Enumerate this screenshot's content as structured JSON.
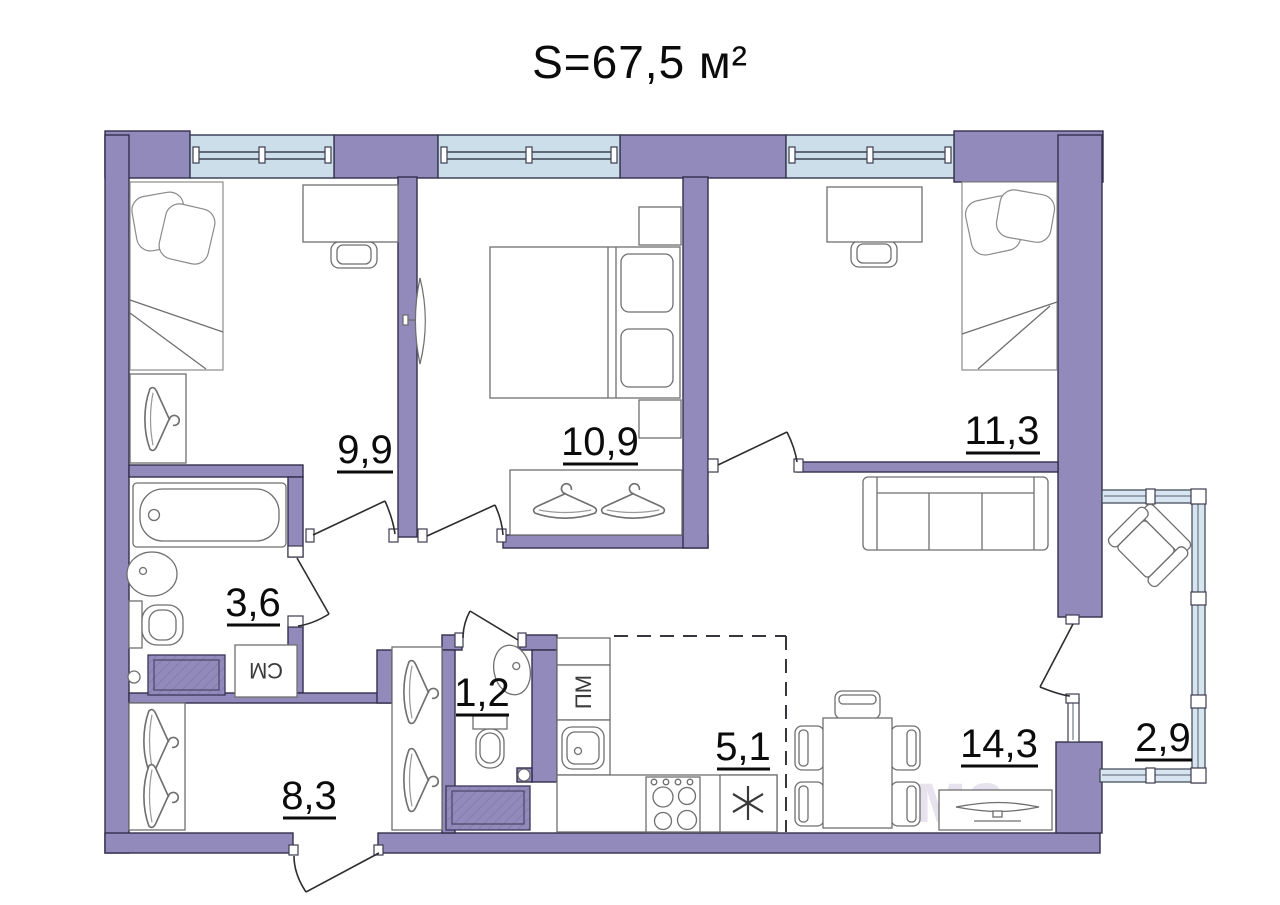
{
  "title": "S=67,5 м²",
  "rooms": {
    "bedroom1": "9,9",
    "bedroom2": "10,9",
    "bedroom3": "11,3",
    "bathroom": "3,6",
    "wc": "1,2",
    "hallway": "8,3",
    "kitchen": "5,1",
    "living": "14,3",
    "balcony": "2,9"
  },
  "labels": {
    "washing_machine": "СМ",
    "dishwasher": "ПМ"
  },
  "watermark": {
    "text_fragment": "ма",
    "digits": "486"
  },
  "colors": {
    "wall": "#938ABC",
    "window": "#CBDEEA",
    "balcony_glazing": "#D6E5EF",
    "line": "#332E4D"
  }
}
